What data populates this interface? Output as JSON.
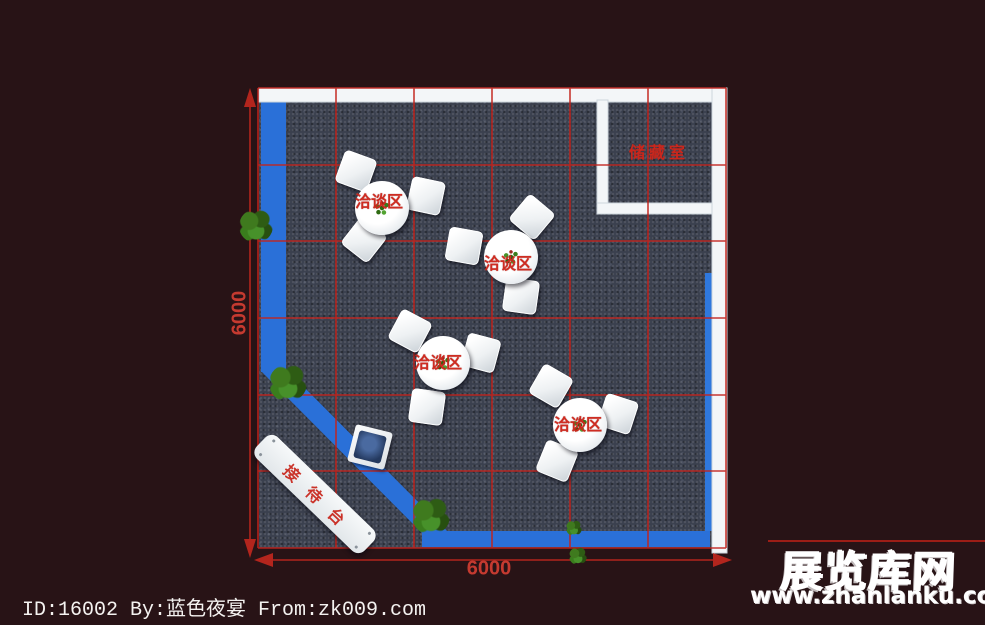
{
  "plan": {
    "storage_room_label": "储藏室",
    "reception_desk_label": "接待台",
    "negotiation_areas": [
      {
        "label": "洽谈区"
      },
      {
        "label": "洽谈区"
      },
      {
        "label": "洽谈区"
      },
      {
        "label": "洽谈区"
      }
    ],
    "dimensions": {
      "width_label": "6000",
      "height_label": "6000"
    }
  },
  "footer": {
    "credit_line": "ID:16002 By:蓝色夜宴 From:zk009.com"
  },
  "watermark": {
    "site_name": "展览库网",
    "site_url": "www.zhanlanku.com"
  },
  "colors": {
    "background": "#281316",
    "carpet": "#3b404e",
    "walkway_blue": "#2a70d8",
    "wall_white": "#f3f6f8",
    "grid_red": "#c3231c",
    "label_red": "#d0281c"
  }
}
